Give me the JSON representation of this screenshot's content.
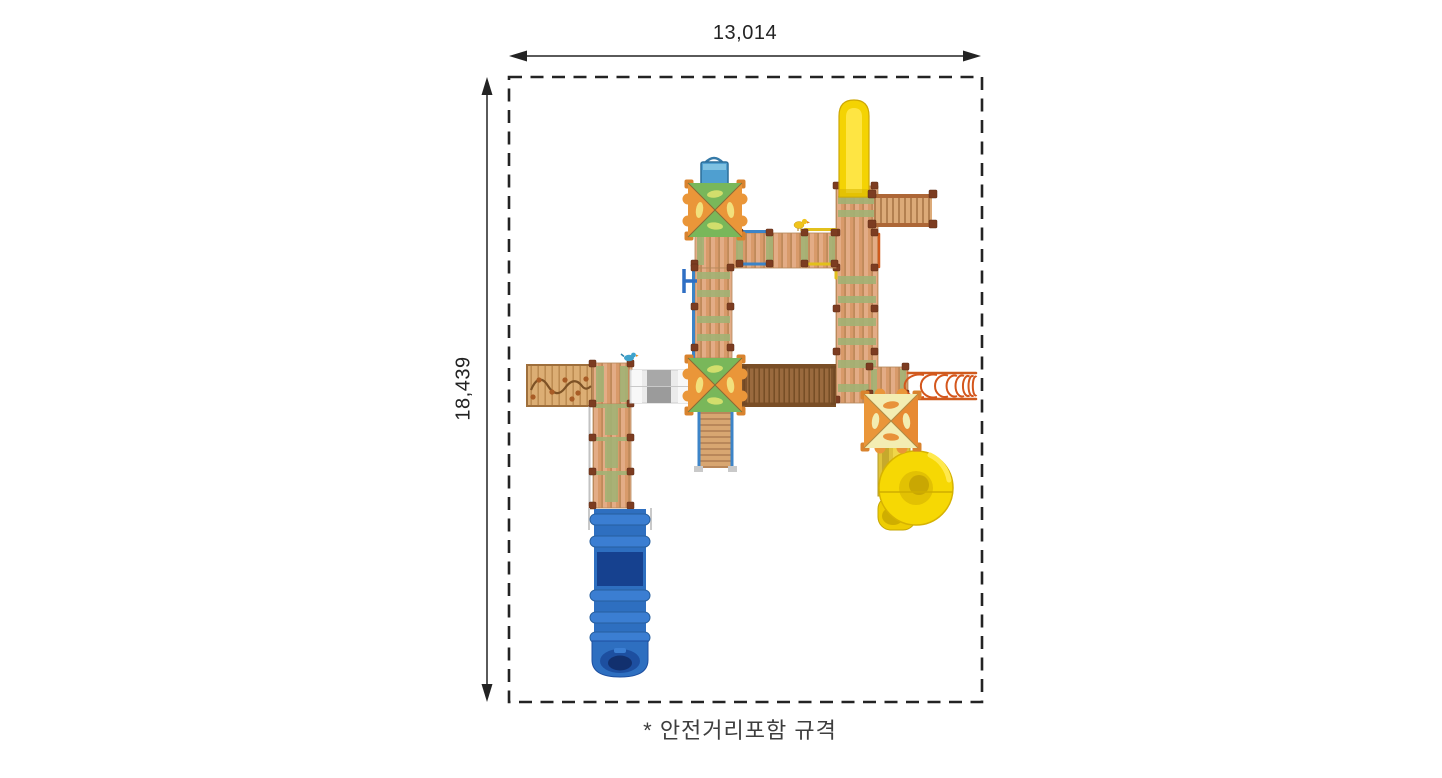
{
  "page": {
    "background_color": "#ffffff"
  },
  "dimensions": {
    "width_label": "13,014",
    "height_label": "18,439"
  },
  "caption": {
    "text": "* 안전거리포함 규격"
  },
  "boundary": {
    "style": "dashed",
    "color": "#232323"
  },
  "components": [
    {
      "name": "straight-tube-slide",
      "color": "#f4d303"
    },
    {
      "name": "spiral-tube-slide",
      "color": "#f6d804"
    },
    {
      "name": "tube-slide",
      "color": "#2e6fc0"
    },
    {
      "name": "crawl-tunnel",
      "color": "#ebebeb"
    },
    {
      "name": "suspension-bridge",
      "color": "#9a6a3e"
    },
    {
      "name": "arch-climber",
      "color": "#d4561c"
    },
    {
      "name": "climbing-wall",
      "color": "#dcae74"
    },
    {
      "name": "rung-bridge",
      "color": "#dcaa78"
    },
    {
      "name": "pyramid-roof-green-orange",
      "colors": [
        "#79b75a",
        "#ea9639"
      ]
    },
    {
      "name": "pyramid-roof-cream-orange",
      "colors": [
        "#f3edb2",
        "#e8923a"
      ]
    },
    {
      "name": "wood-deck",
      "color": "#d89a6a"
    },
    {
      "name": "panel-box",
      "color": "#4f9fd0"
    }
  ],
  "colors": {
    "line": "#232323",
    "caption_text": "#3e3e3e",
    "deck_wood": "#d89a6a",
    "deck_green": "#a2b174",
    "post": "#7c3c21",
    "rail_blue": "#3c84c8",
    "rail_yellow": "#e2c01c",
    "rail_orange": "#cf5a1e"
  }
}
